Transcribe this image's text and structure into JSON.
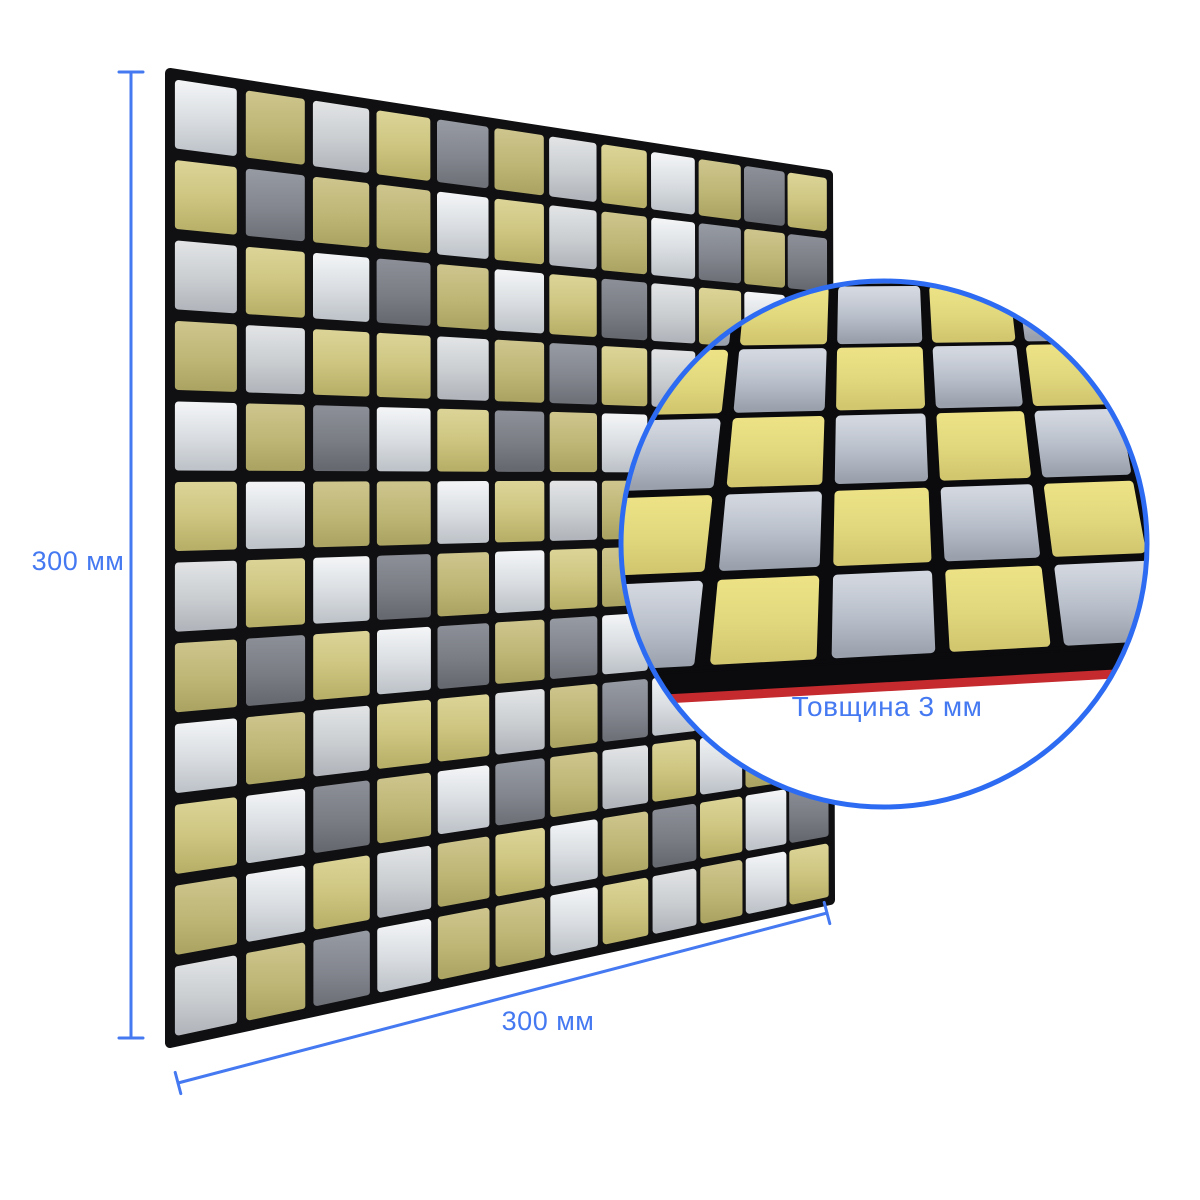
{
  "labels": {
    "height": "300 мм",
    "width": "300 мм",
    "thickness": "Товщина 3 мм"
  },
  "panel": {
    "rows": 12,
    "cols": 12,
    "tiles": [
      "SGSGDGSGSGDG",
      "GDGGSGSGSDGD",
      "SGSDGSGDSGSG",
      "GSGGSGDGSGDS",
      "SGDSGDGSGSGG",
      "GSGGSGSGDGSD",
      "SGSDGSGGSDGS",
      "GDGSDGDSGGSG",
      "SGSGGSGDSGDS",
      "GSDGSDGSGSGG",
      "GSGSGGSGDGSD",
      "SGDSGGSGSGSG"
    ],
    "tile_colors": {
      "G": {
        "light": "#dbd395",
        "mid": "#ccc47e",
        "dark": "#b8b069"
      },
      "S": {
        "light": "#f1f3f5",
        "mid": "#d8dce0",
        "dark": "#bfc4ca"
      },
      "D": {
        "light": "#9599a1",
        "mid": "#83868e",
        "dark": "#6e7178"
      }
    },
    "grout": "#101012"
  },
  "inset": {
    "rows": 6,
    "cols": 5,
    "pattern": "checkerboard",
    "checkerboard_start": "G",
    "tile_colors": {
      "G": {
        "light": "#ece285",
        "mid": "#e0d67c",
        "dark": "#d2c76f"
      },
      "S": {
        "light": "#d3d8e0",
        "mid": "#b8bec9",
        "dark": "#9aa1ad"
      }
    },
    "grout": "#0b0b0d",
    "adhesive_stripe": "#c42a2e"
  },
  "colors": {
    "annotation": "#4579f1",
    "circle_border": "#2d6cf2",
    "background": "#ffffff"
  }
}
